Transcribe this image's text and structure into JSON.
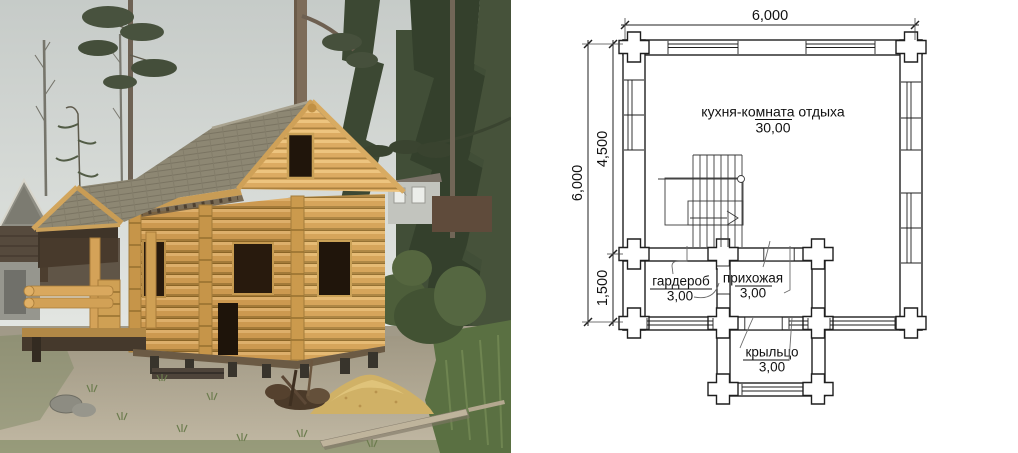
{
  "photo": {
    "subject": "Log house under construction in a pine forest",
    "colors": {
      "sky": "#cbd0cd",
      "logs": "#d29f54",
      "log_highlight": "#e4b771",
      "roof": "#8d8773",
      "ground": "#ab9f8b",
      "sand": "#d3b267",
      "spruce": "#3c4833",
      "grass": "#5a7042",
      "window_opening": "#241a10"
    }
  },
  "plan": {
    "stroke": "#1f1f1f",
    "dimensions": {
      "top_width": "6,000",
      "left_total": "6,000",
      "left_upper": "4,500",
      "left_lower": "1,500"
    },
    "rooms": [
      {
        "name": "кухня-комната отдыха",
        "area": "30,00"
      },
      {
        "name": "гардероб",
        "area": "3,00"
      },
      {
        "name": "прихожая",
        "area": "3,00"
      },
      {
        "name": "крыльцо",
        "area": "3,00"
      }
    ]
  }
}
